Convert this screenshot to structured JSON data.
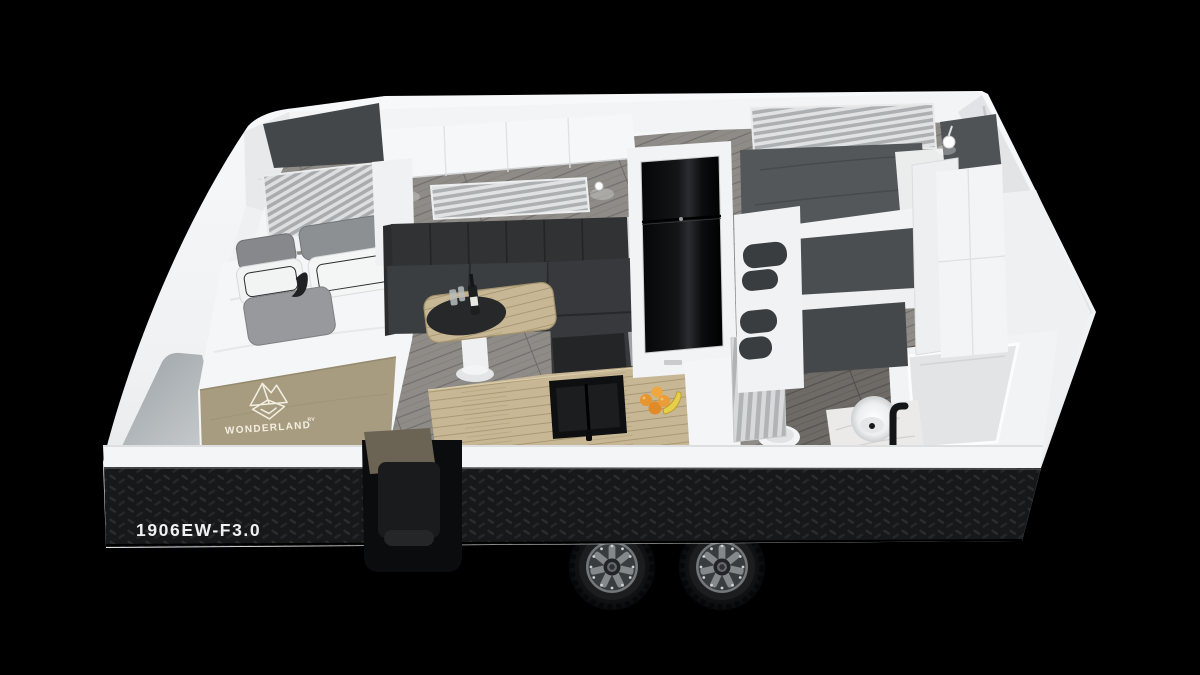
{
  "page": {
    "background_color": "#000000",
    "subject": "3D cutaway render of a caravan interior floor plan"
  },
  "branding": {
    "logo_icon": "wonderland-mountain-diamond-logo",
    "brand_name": "WONDERLAND",
    "brand_suffix": "RV",
    "text_color": "#f3efe2"
  },
  "exterior": {
    "model_label": "1906EW-F3.0",
    "model_label_color": "#eef0f1",
    "body_color": "#f2f3f5",
    "skirt_finish": "black-checker-plate",
    "wheel_count": 2
  },
  "interior_features": [
    {
      "name": "front-bed",
      "details": "white duvet, tan Wonderland blanket, grey and white pillows, dark headboard, striped window blind"
    },
    {
      "name": "dinette",
      "details": "charcoal L-shaped lounge, timber pedestal table, wine bottle and glasses on black placemat"
    },
    {
      "name": "kitchen",
      "details": "timber benchtop, black double-bowl sink, oranges and banana"
    },
    {
      "name": "fridge",
      "details": "full-height gloss black fridge in white cabinetry"
    },
    {
      "name": "bunks",
      "details": "triple bunks with grey bedding and oval cut-out rails, striped blind above"
    },
    {
      "name": "bathroom",
      "details": "toilet, round basin on marble vanity with black tap, shower cubicle, pleated curtain"
    },
    {
      "name": "lighting",
      "details": "white reading lamps over dinette and rear corner"
    }
  ]
}
